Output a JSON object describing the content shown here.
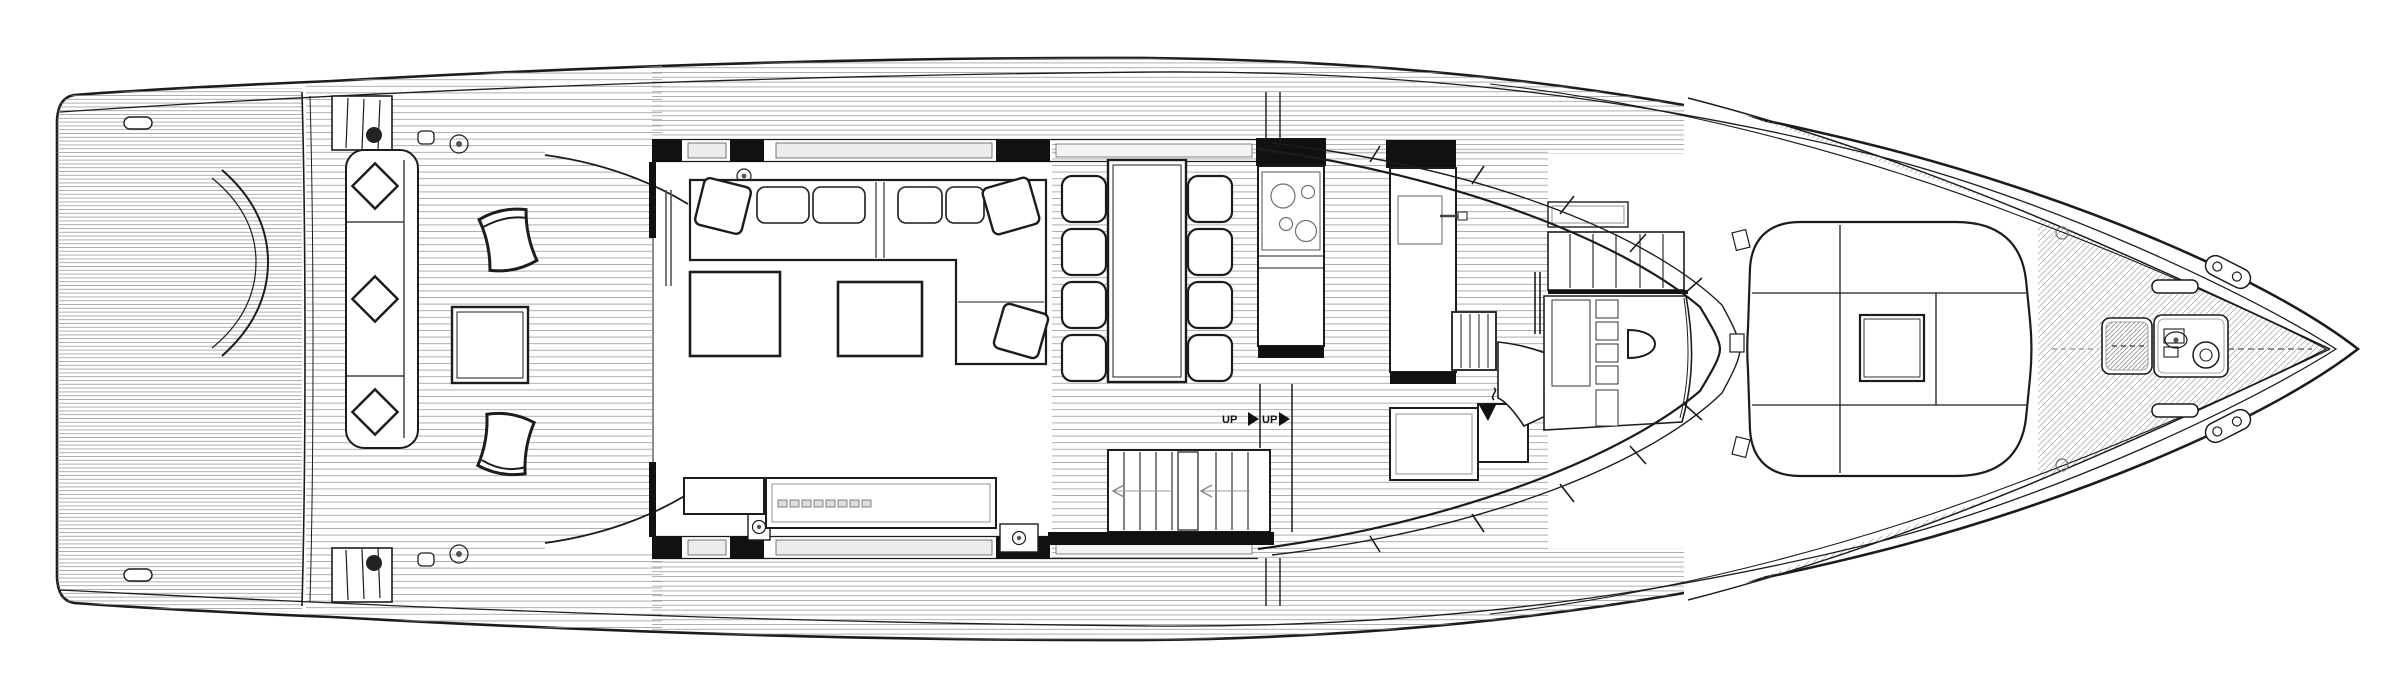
{
  "drawing": {
    "labels": {
      "stair_up_1": "UP",
      "stair_up_2": "UP"
    },
    "icons": [
      "up-direction-triangle-icon",
      "up-direction-triangle-icon",
      "stairs-direction-chevron-icon",
      "stairs-direction-chevron-icon",
      "s-curve-arrow-icon",
      "windlass-icon",
      "cooktop-burners-icon"
    ],
    "colors": {
      "background": "#ffffff",
      "ink": "#1c1c1c",
      "black_fill": "#111111",
      "teak_line": "#8f8f8f",
      "glass_fill": "#ececec"
    }
  }
}
